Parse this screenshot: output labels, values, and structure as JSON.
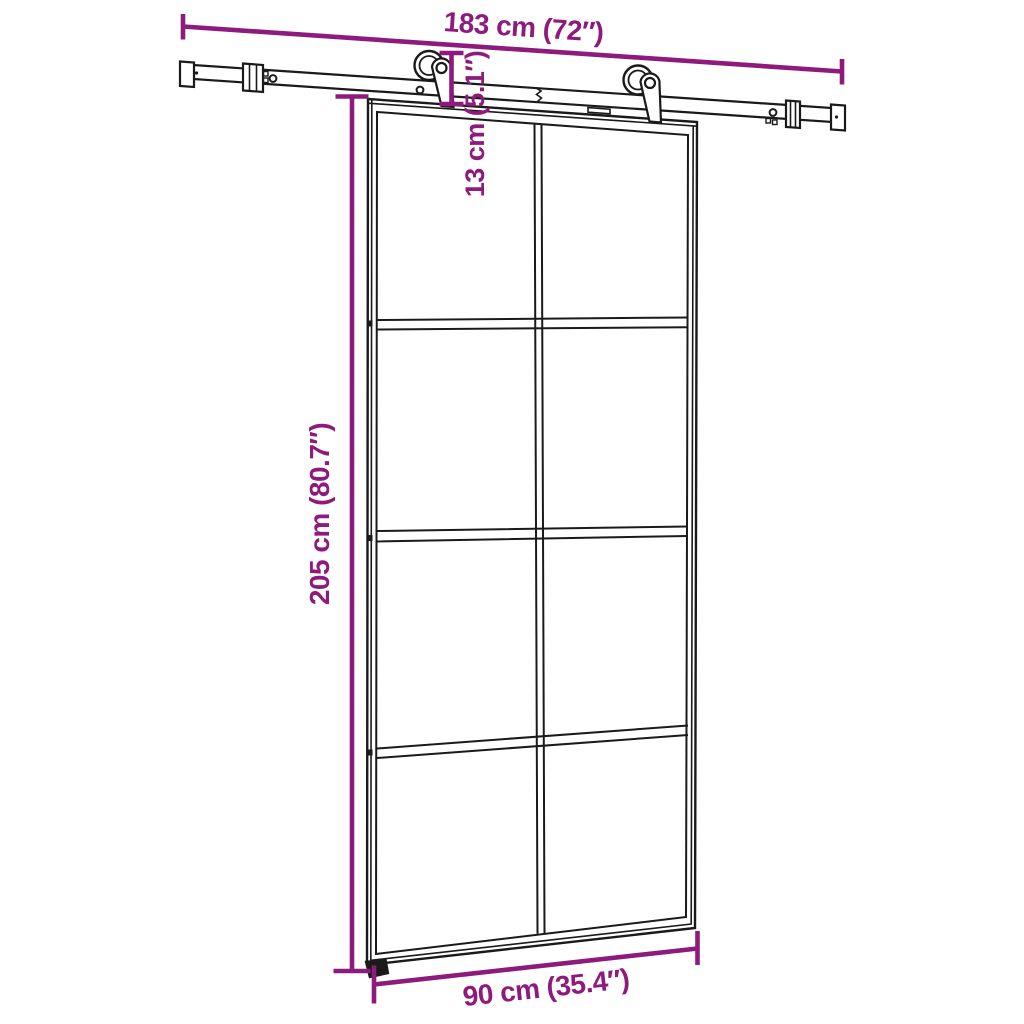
{
  "diagram": {
    "background_color": "#ffffff",
    "line_art_color": "#1a1a1a",
    "dimension_color": "#8E1A7E",
    "dimensions": {
      "track_length": {
        "label": "183 cm (72″)",
        "orientation": "horizontal-top"
      },
      "hanger_drop": {
        "label": "13 cm (5.1″)",
        "orientation": "vertical-rotated"
      },
      "door_height": {
        "label": "205 cm (80.7″)",
        "orientation": "vertical-rotated"
      },
      "door_width": {
        "label": "90 cm (35.4″)",
        "orientation": "horizontal-bottom"
      }
    },
    "door": {
      "glass_columns": 2,
      "glass_rows": 4,
      "glass_panels": 8
    },
    "hardware": {
      "rollers": 2,
      "wall_brackets": 2,
      "end_caps": 2,
      "rail_holes": 4,
      "floor_guides": 1
    }
  }
}
